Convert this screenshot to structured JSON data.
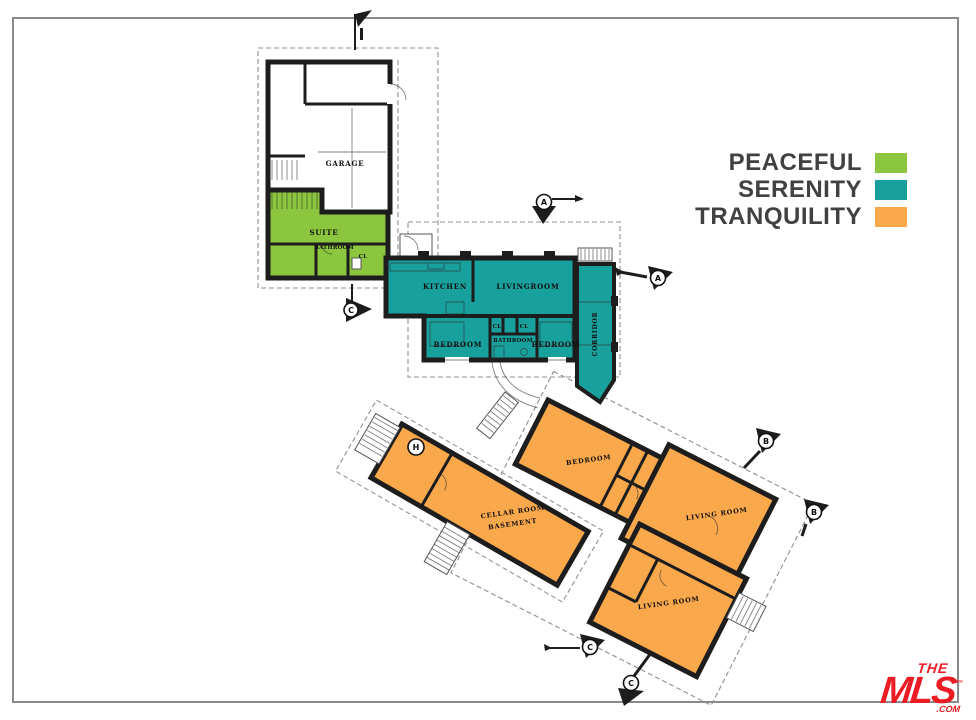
{
  "legend": {
    "items": [
      {
        "label": "PEACEFUL",
        "color": "#8CC63F"
      },
      {
        "label": "SERENITY",
        "color": "#18A09D"
      },
      {
        "label": "TRANQUILITY",
        "color": "#F9A84C"
      }
    ]
  },
  "rooms": {
    "garage": "GARAGE",
    "suite": "SUITE",
    "suite_bathroom": "BATHROOM",
    "suite_closet": "CL",
    "kitchen": "KITCHEN",
    "livingroom": "LIVINGROOM",
    "closet_1": "CL",
    "closet_2": "CL",
    "bedroom_1": "BEDROOM",
    "bathroom": "BATHROOM",
    "bedroom_2": "BEDROOM",
    "corridor": "CORRIDOR",
    "bedroom_3": "BEDROOM",
    "living_room_1": "LIVING ROOM",
    "living_room_2": "LIVING ROOM",
    "cellar_line_1": "CELLAR ROOM",
    "cellar_line_2": "BASEMENT"
  },
  "markers": {
    "a1": "A",
    "a2": "A",
    "b1": "B",
    "b2": "B",
    "c1": "C",
    "c2": "C",
    "c3": "C",
    "h": "H"
  },
  "logo": {
    "the": "THE",
    "mls": "MLS",
    "tm": "™",
    "com": ".COM",
    "color": "#EC1C24"
  }
}
